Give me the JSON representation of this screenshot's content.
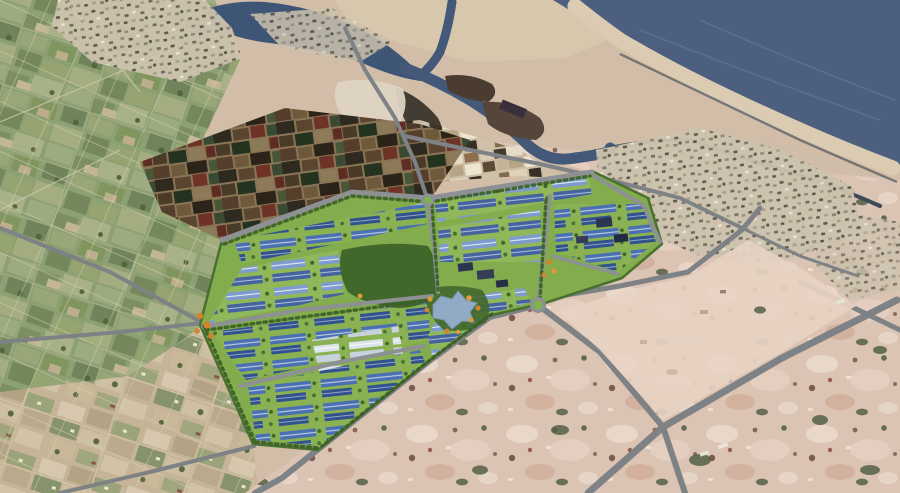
{
  "meta": {
    "scene": "aerial-photo-with-industrial-park-masterplan-rendering",
    "view": "oblique-birdseye"
  },
  "palette": {
    "terrain_base": "#d2bea8",
    "fields_green": "#8da073",
    "fields_tan": "#c6b498",
    "bare_land": "#dcc4b4",
    "pink_zone": "#e7d2c3",
    "ocean": "#4c5f7e",
    "bay": "#3e5575",
    "river": "#44597a",
    "beach": "#dbcbb2",
    "sand_spit": "#d7c7ac",
    "road": "#7e8285",
    "road_minor": "#8d9194",
    "coast_road": "#5f6366",
    "park_green": "#83ac4d",
    "park_tree": "#3b5f26",
    "factory_blue": "#4a70b2",
    "factory_blue_dark": "#31528c",
    "factory_blue_light": "#7e9bd0",
    "factory_white": "#dde3ea",
    "lake": "#91aac5",
    "orange_tree": "#d2842e",
    "roundabout_green": "#7fb34e",
    "dark_building": "#2c3550",
    "town_base": "#ccc2ad",
    "pond_dark": "#3a2f22",
    "island_dark": "#4a3c30",
    "canal_dark": "#3e4a56"
  },
  "scene_elements": {
    "ocean": "sea-top-right",
    "bay": "lagoon-top-left",
    "river": "estuary-channel-with-islands",
    "coast": "curved-beach-strip",
    "ponds": "dark-aquaculture-patchwork",
    "salt_flats": "light-salt-pond-area",
    "town": "coastal-town-texture",
    "park": "rendered-industrial-park",
    "park_features": "blue-roof-factories, white-roof-factories, central-forest, star-lake, two-roundabouts, orange-trees, utility-buildings, tree-lined-roads",
    "farmland_west": "green-field-grid",
    "farmland_south": "tan-field-patchwork",
    "bare_east": "pink-cleared-land-with-roads"
  }
}
